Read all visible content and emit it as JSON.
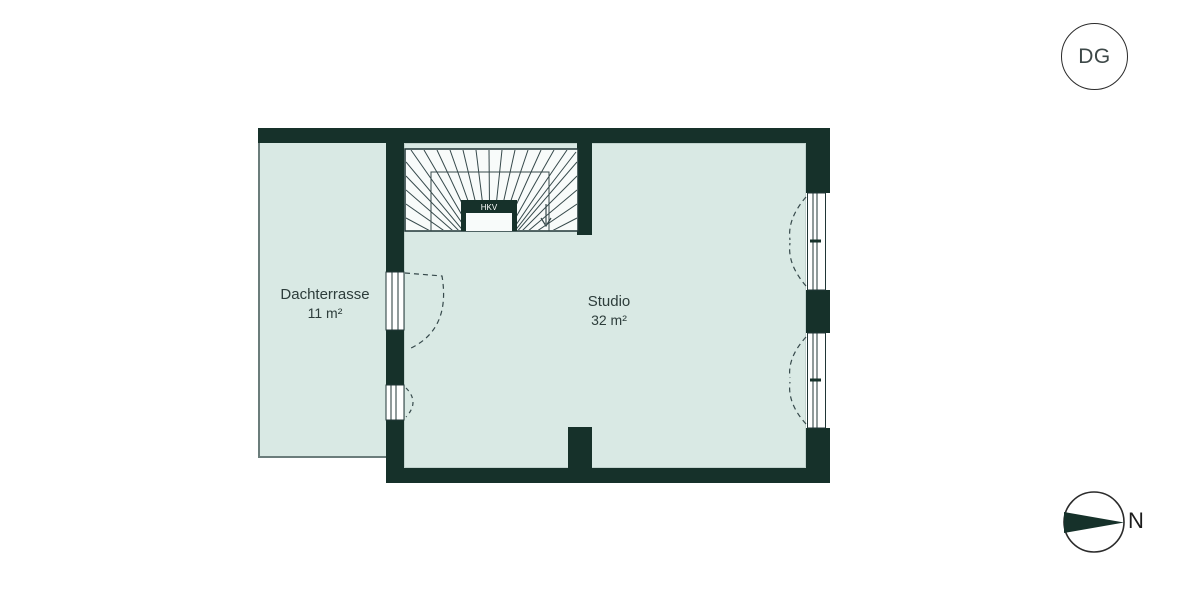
{
  "floor_badge": {
    "label": "DG"
  },
  "rooms": [
    {
      "name": "Dachterrasse",
      "area": "11 m²"
    },
    {
      "name": "Studio",
      "area": "32 m²"
    }
  ],
  "stair": {
    "label": "HKV"
  },
  "compass": {
    "label": "N"
  },
  "colors": {
    "wall": "#16312a",
    "floor": "#d9e9e4",
    "stair-fill": "#f8fbfa",
    "line": "#36494b",
    "rail": "#6b7d7b",
    "text": "#2d3d3b",
    "stroke": "#203636",
    "circle": "#2b2b2b"
  }
}
